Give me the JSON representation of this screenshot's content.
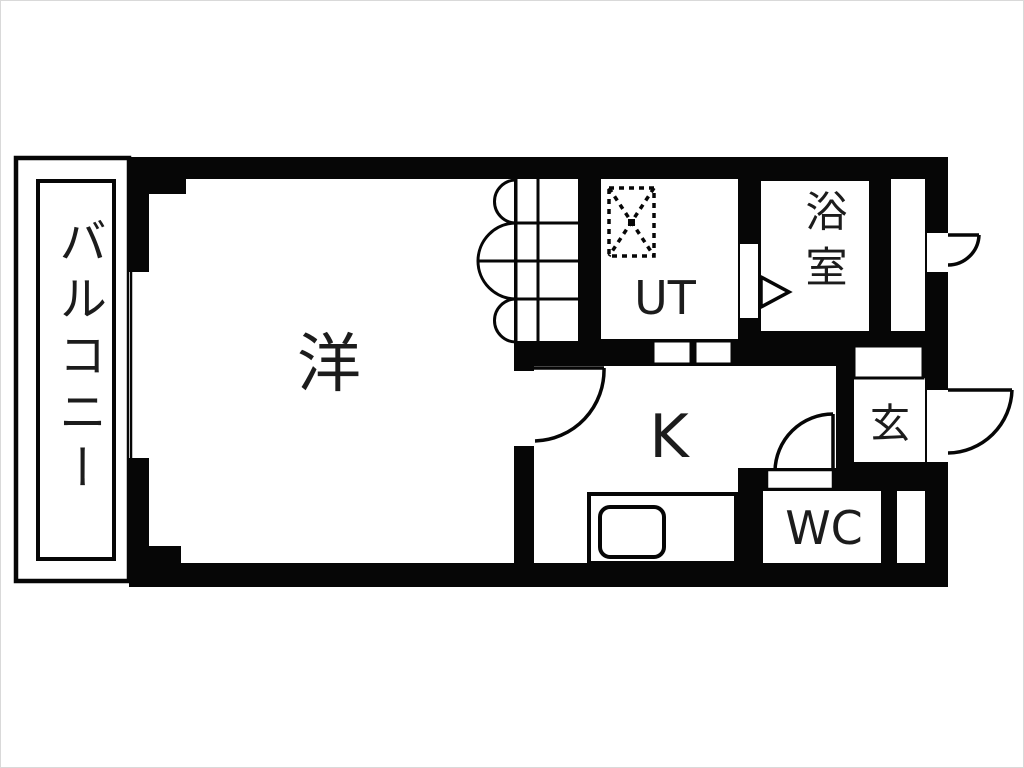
{
  "figure": {
    "type": "apartment-floor-plan",
    "style": "black-wall monochrome Japanese madori drawing"
  },
  "labels": {
    "balcony": "バルコニー",
    "western_room": "洋",
    "utility": "UT",
    "bathroom": "浴室",
    "kitchen": "K",
    "entrance": "玄",
    "toilet": "WC"
  },
  "symbols": {
    "washer_pan": "dashed-square-with-x",
    "bathroom_door": "triangle-arrow",
    "closet_door": "accordion-fold-arcs",
    "swing_doors": 4,
    "kitchen_sink": "rounded-rect-in-counter"
  },
  "colors": {
    "wall": "#060606",
    "floor": "#ffffff",
    "text": "#1c1c1c",
    "page_border": "#d9d9d9"
  }
}
